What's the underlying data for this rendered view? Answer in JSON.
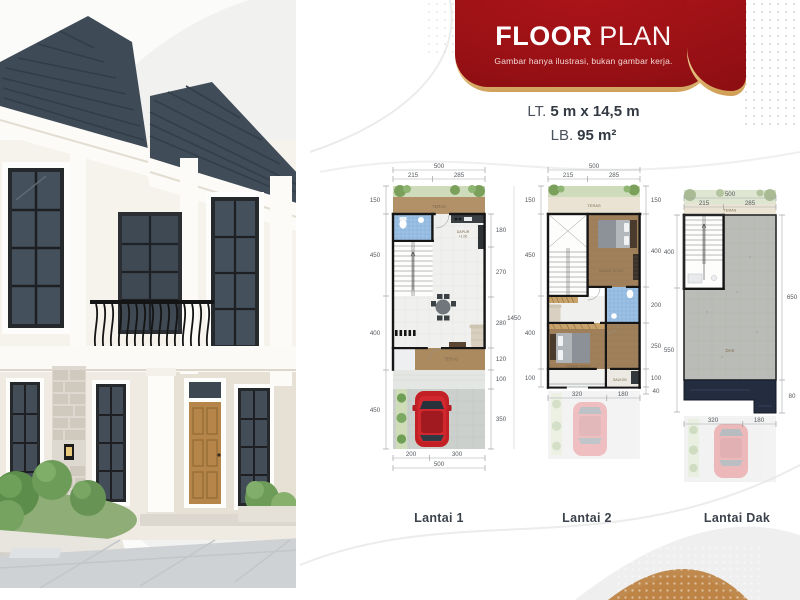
{
  "header": {
    "title_primary": "FLOOR",
    "title_secondary": "PLAN",
    "subtitle": "Gambar hanya ilustrasi, bukan gambar kerja."
  },
  "specs": {
    "land_label": "LT.",
    "land_value": "5 m x 14,5 m",
    "building_label": "LB.",
    "building_value": "95 m²"
  },
  "colors": {
    "banner_red": "#9A1115",
    "gold": "#D9A55F",
    "roof_navy": "#242D3F",
    "accent_copper": "#C08A4F"
  },
  "plans": [
    {
      "label": "Lantai 1",
      "dims": {
        "top_total": "500",
        "top_left": "215",
        "top_right": "285",
        "left": [
          "150",
          "450",
          "400",
          "450"
        ],
        "right": [
          "180",
          "270",
          "280",
          "120",
          "100",
          "350"
        ],
        "overall": "1450",
        "bottom": [
          "200",
          "300"
        ],
        "bottom_total": "500"
      },
      "rooms": {
        "teras_top": "TERAS",
        "dapur": "DAPUR",
        "dapur_level": "+1.00",
        "teras_bottom": "TERAS"
      }
    },
    {
      "label": "Lantai 2",
      "dims": {
        "top_total": "500",
        "top_left": "215",
        "top_right": "285",
        "left": [
          "150",
          "450",
          "400",
          "100"
        ],
        "right": [
          "150",
          "400",
          "200",
          "250",
          "100",
          "40"
        ],
        "bottom": [
          "320",
          "180"
        ]
      },
      "rooms": {
        "teras": "TERAS",
        "bedroom1": "KAMAR TIDUR",
        "bedroom2": "KAMAR TIDUR",
        "balcony": "BALKON"
      }
    },
    {
      "label": "Lantai Dak",
      "dims": {
        "top_total": "500",
        "top_left": "215",
        "top_right": "285",
        "left": [
          "400",
          "550"
        ],
        "right": [
          "650",
          "80"
        ],
        "bottom": [
          "320",
          "180"
        ]
      },
      "rooms": {
        "teras": "TERAS",
        "dak": "DAK"
      }
    }
  ]
}
